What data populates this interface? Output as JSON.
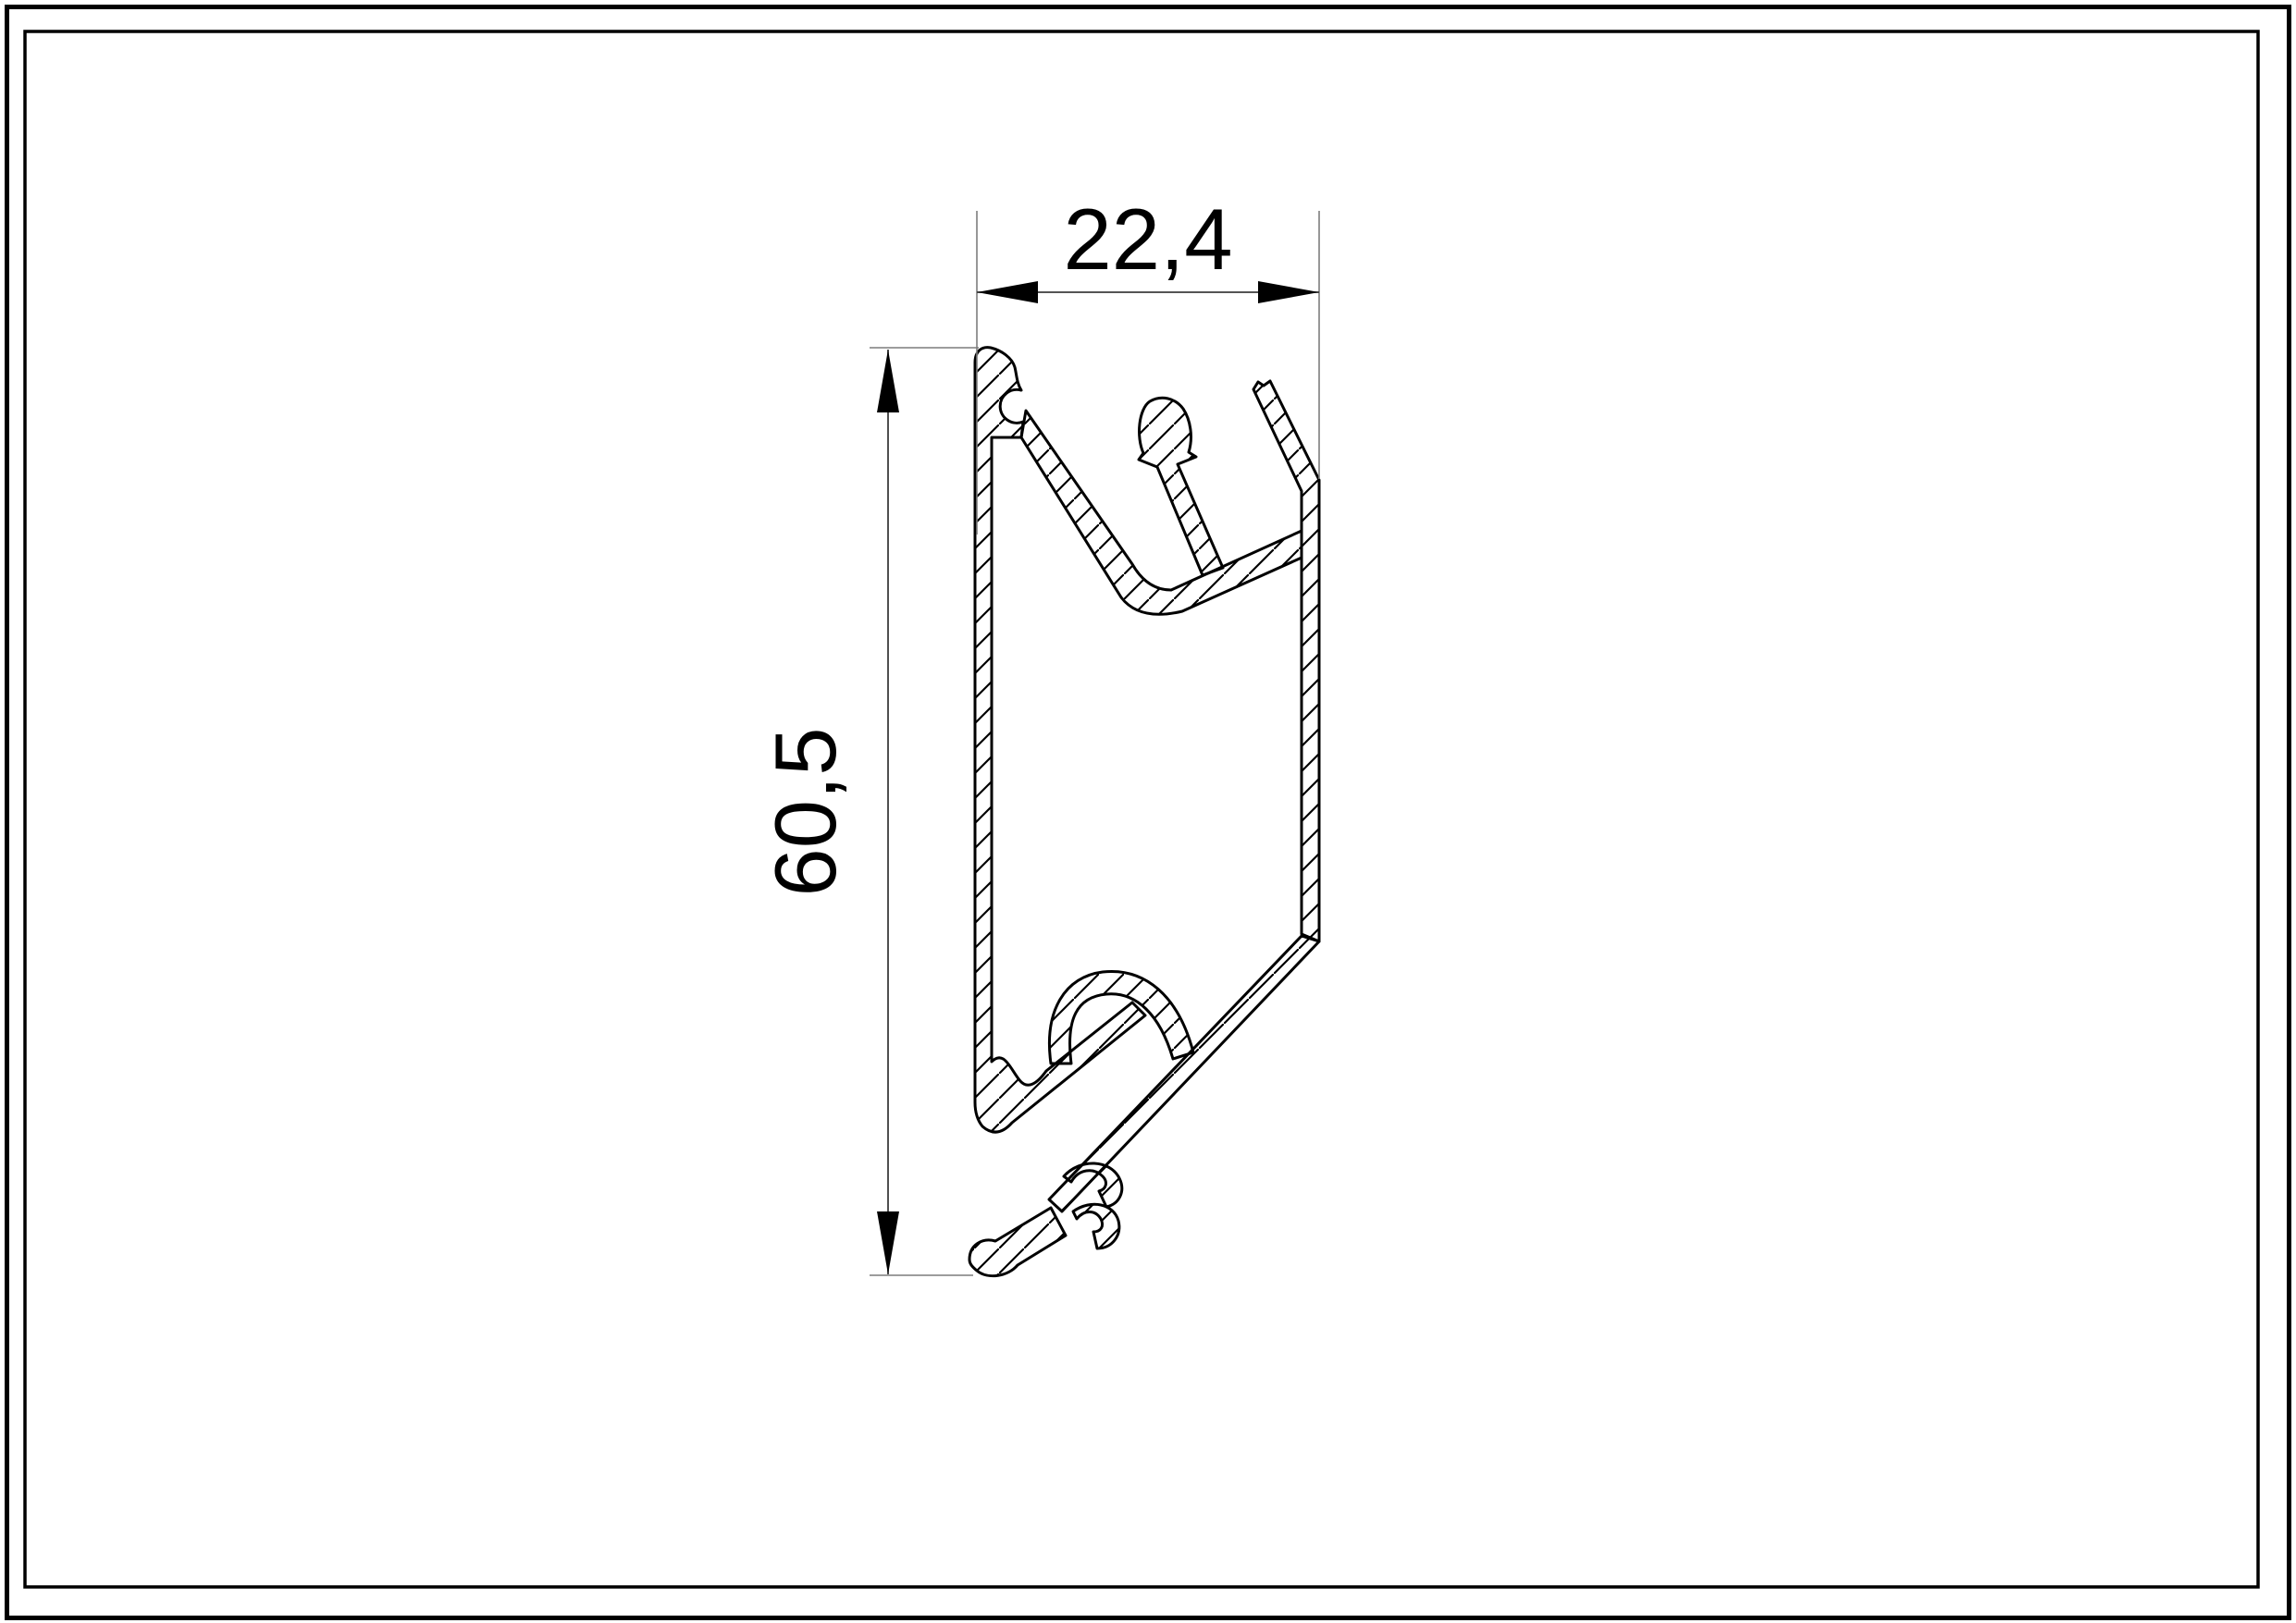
{
  "document": {
    "type": "technical-drawing",
    "description": "Cross-section of an extruded aluminium profile with section hatching, shown inside a double drawing frame with two linear dimensions"
  },
  "colors": {
    "background": "#ffffff",
    "outline": "#000000",
    "hatch": "#000000",
    "frame": "#000000",
    "dimension_line": "#3c3c3c",
    "extension_line": "#7d7d7d",
    "arrow": "#000000",
    "text": "#000000"
  },
  "dimensions": {
    "width": {
      "label": "22,4",
      "orientation": "horizontal"
    },
    "height": {
      "label": "60,5",
      "orientation": "vertical"
    }
  }
}
